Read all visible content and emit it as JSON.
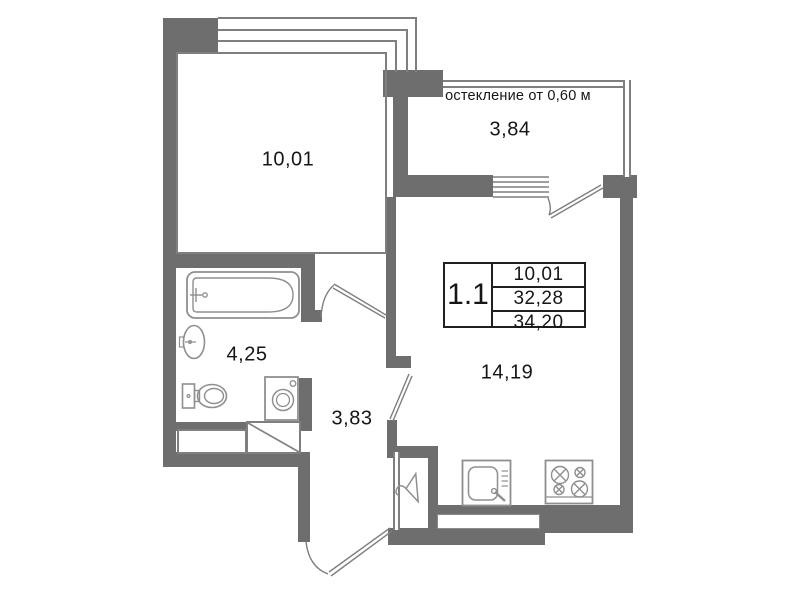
{
  "rooms": {
    "living": {
      "label": "10,01"
    },
    "balcony": {
      "label": "3,84",
      "glazing_note": "остекление от 0,60 м"
    },
    "bathroom": {
      "label": "4,25"
    },
    "hallway": {
      "label": "3,83"
    },
    "kitchen_living": {
      "label": "14,19"
    }
  },
  "info_table": {
    "unit": "1.1",
    "living_area": "10,01",
    "area": "32,28",
    "total_area": "34,20"
  },
  "colors": {
    "wall": "#6e6e6e",
    "thin_line": "#7f7f7f",
    "fixture_line": "#8f8f8f",
    "text": "#161616",
    "table_border": "#202020"
  }
}
